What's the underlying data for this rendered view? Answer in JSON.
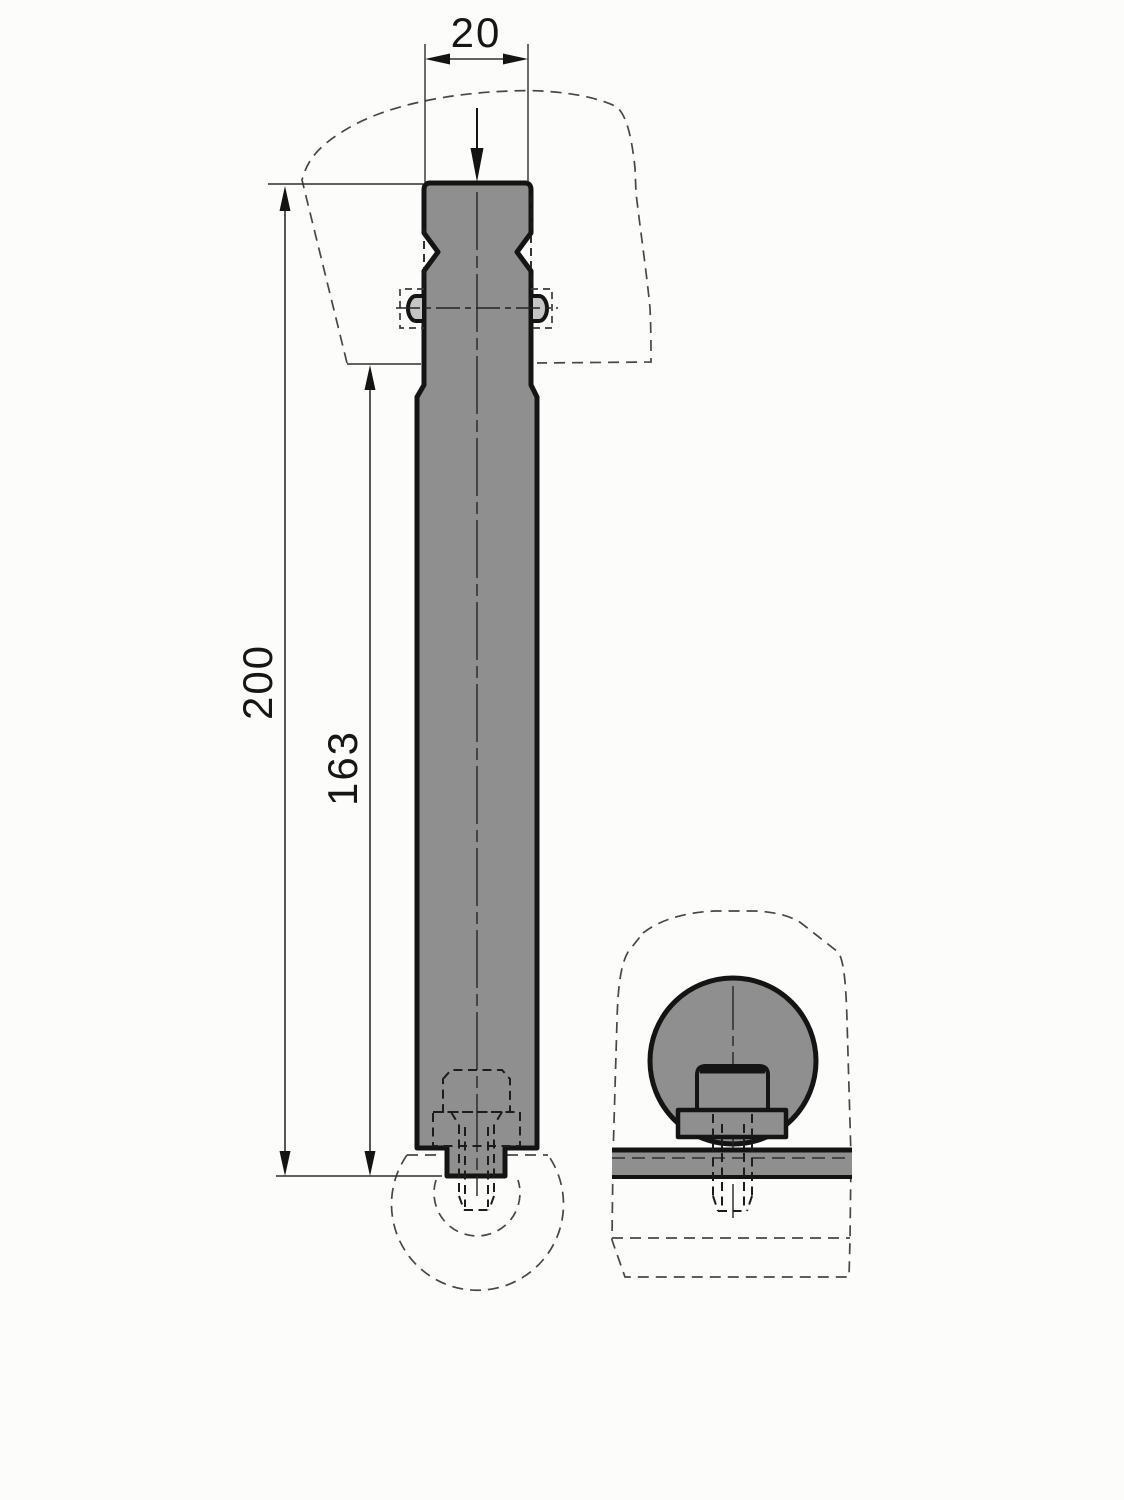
{
  "page": {
    "title": "Technical part drawing, front and side views",
    "background": "#fcfdfa"
  },
  "drawing": {
    "kind": "2D CAD drawing",
    "dimensions": {
      "head_width": "20",
      "overall_length": "200",
      "body_length": "163"
    },
    "colors": {
      "part_fill": "#8f8f8f",
      "pin_fill": "#c5c5c5",
      "outline": "#141414",
      "thin_line": "#2e2e2e",
      "hidden_line": "#1c1c1c",
      "phantom_line": "#474747",
      "background": "#fcfdfa"
    },
    "icons": {
      "load_arrow": "down-arrow",
      "dimension_arrows": "filled-triangle-arrowheads"
    }
  }
}
